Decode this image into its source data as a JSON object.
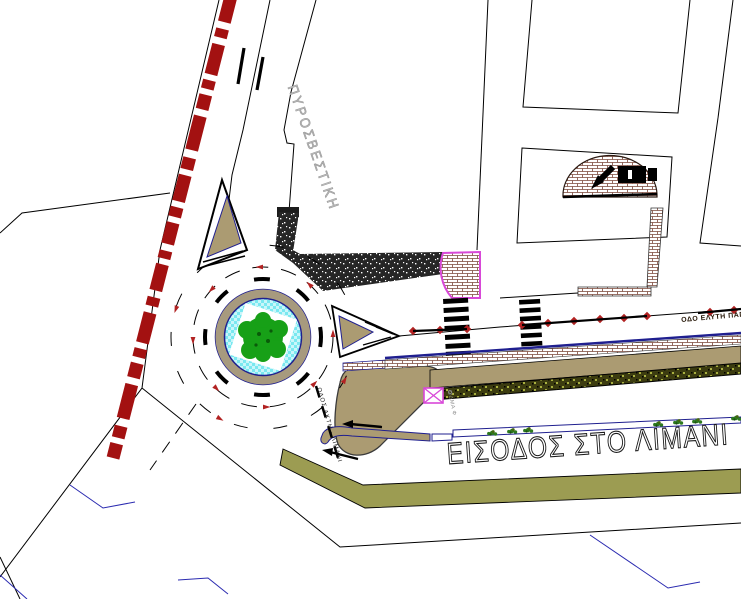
{
  "meta": {
    "title": "Urban traffic site plan - port entrance roundabout",
    "type": "cad-site-plan"
  },
  "labels": {
    "fire_station": "ΠΥΡΟΣΒΕΣΤΙΚΗ",
    "port_entrance": "ΕΙΣΟΔΟΣ ΣΤΟ ΛΙΜΑΝΙ",
    "street_east": "ΟΔΟ ΕΛΥΤΗ ΠΑΠΑ",
    "street_south": "ΟΔΟΣ ΑΚΤΗ - ΛΙΜΑΝΙ",
    "utility_note": "ΟΔΜΑ Φ"
  },
  "features": [
    "striped railway-boundary band",
    "fire-station building",
    "warehouse buildings",
    "brick-paved dome forecourt with entrance arrow",
    "dark stippled sidewalk",
    "two zebra pedestrian crossings",
    "roundabout with water ring and central tree island",
    "chevron traffic islands",
    "street centerline with red diamond markers",
    "median strip with brick paving, tan walk and hedge planting",
    "port entrance road",
    "olive embankment band",
    "utility box symbol",
    "parcel boundary lines"
  ],
  "colors": {
    "line": "#000000",
    "red_band": "#a31111",
    "tan": "#ab9b72",
    "ring_tan": "#a79a7e",
    "water_cyan": "#7ae8f0",
    "water_light": "#c9f6fa",
    "tree_green": "#17a017",
    "tree_dark": "#0a5a0a",
    "hedge_olive": "#3c3c10",
    "hedge_dot": "#a8b040",
    "band_olive": "#9c9c52",
    "navy": "#1f1f8f",
    "bound_blue": "#2a2ab0",
    "magenta": "#d848d8",
    "brick": "#7a4638",
    "red_marker": "#b22222",
    "bush_green": "#2d7a1f"
  }
}
